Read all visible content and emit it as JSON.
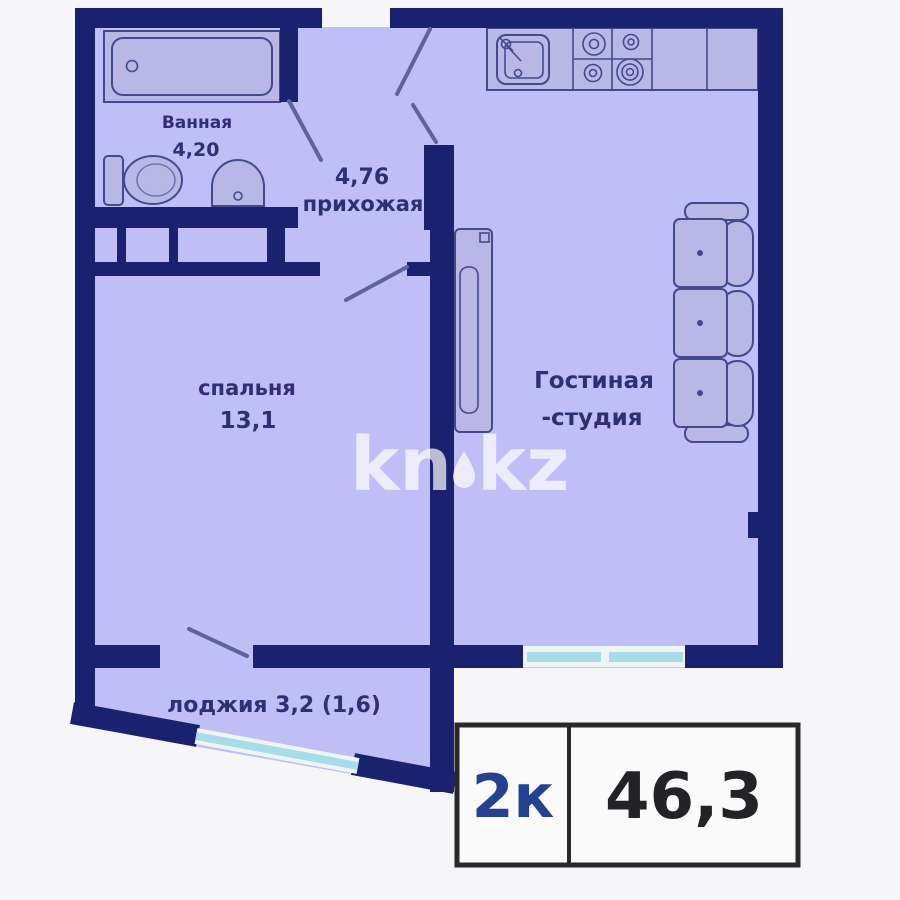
{
  "colors": {
    "bg": "#f6f6f8",
    "wall": "#1a2270",
    "room": "#bfbef7",
    "furn": "#b8b7e6",
    "line": "#434a8c",
    "door": "#5e639e",
    "win": "#a9dce9",
    "wincase": "#eef5f8",
    "text": "#2c3172",
    "wm": "rgba(255,255,255,0.7)",
    "badgeBg": "#fafafa",
    "badgeBorder": "#29292c",
    "badgeRooms": "#26418f",
    "badgeArea": "#232327"
  },
  "labels": {
    "bathroom_name": "Ванная",
    "bathroom_area": "4,20",
    "hallway_area": "4,76",
    "hallway_name": "прихожая",
    "bedroom_name": "спальня",
    "bedroom_area": "13,1",
    "living_name_line1": "Гостиная",
    "living_name_line2": "-студия",
    "loggia_label": "лоджия 3,2 (1,6)"
  },
  "badge": {
    "rooms": "2к",
    "area": "46,3"
  },
  "watermark": {
    "left": "kn",
    "right": "kz"
  }
}
